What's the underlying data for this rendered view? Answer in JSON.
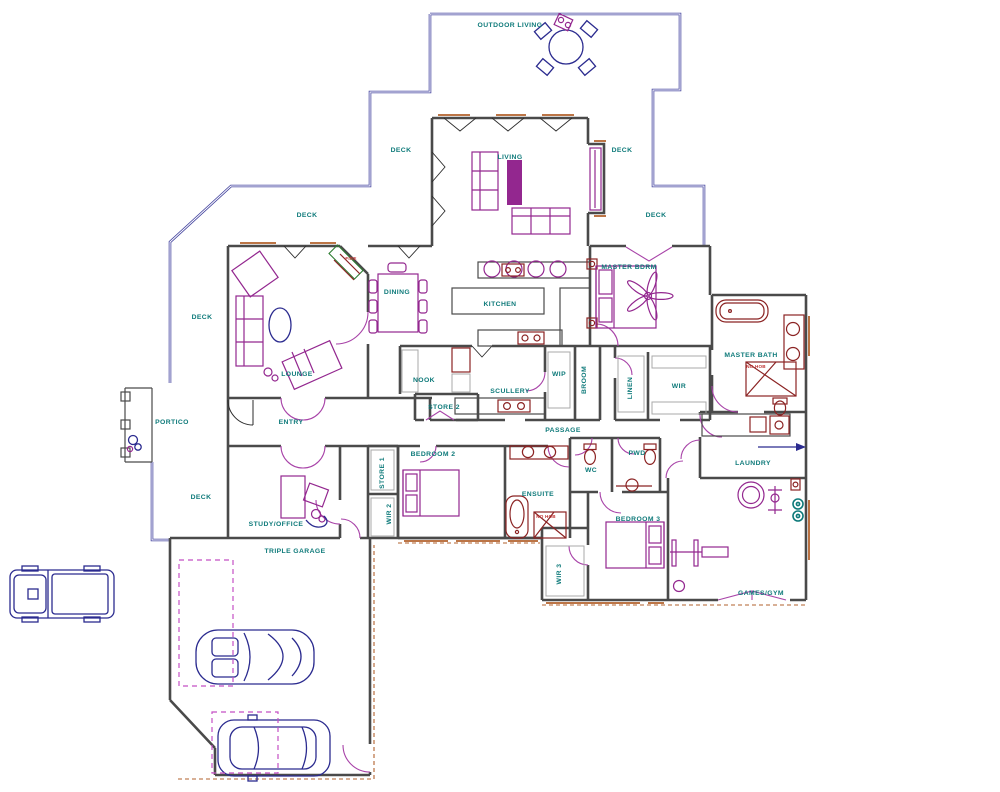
{
  "plan": {
    "rooms": {
      "outdoor_living": "OUTDOOR LIVING",
      "deck": "DECK",
      "living": "LIVING",
      "master_bdrm": "MASTER BDRM",
      "dining": "DINING",
      "kitchen": "KITCHEN",
      "master_bath": "MASTER BATH",
      "lounge": "LOUNGE",
      "nook": "NOOK",
      "wip": "WIP",
      "broom": "BROOM",
      "scullery": "SCULLERY",
      "linen": "LINEN",
      "wir": "WIR",
      "store_2": "STORE 2",
      "portico": "PORTICO",
      "entry": "ENTRY",
      "passage": "PASSAGE",
      "bedroom_2": "BEDROOM 2",
      "pwd": "PWD",
      "wc": "WC",
      "laundry": "LAUNDRY",
      "ensuite": "ENSUITE",
      "store_1": "STORE 1",
      "wir_2": "WIR 2",
      "study_office": "STUDY/OFFICE",
      "bedroom_3": "BEDROOM 3",
      "wir_3": "WIR 3",
      "triple_garage": "TRIPLE GARAGE",
      "games_gym": "GAMES/GYM"
    },
    "annotations": {
      "fire": "FIRE",
      "no_hob": "NO HOB"
    },
    "colors": {
      "wall": "#4a4a4a",
      "deck_line": "#4646a0",
      "furniture": "#93278f",
      "fixture": "#8b2323",
      "door": "#a843a8",
      "label": "#0e7a7a",
      "note": "#c03434",
      "vehicle": "#2b2b8f",
      "window_sill": "#b2622d",
      "dashed_park": "#c44fc4",
      "shelf": "#a8a8a8",
      "teal_symbol": "#0e7a7a"
    },
    "icons": [
      "round-table-icon",
      "bbq-icon",
      "sofa-icon",
      "rug-icon",
      "dining-table-icon",
      "fireplace-icon",
      "bed-icon",
      "ceiling-fan-icon",
      "bath-icon",
      "shower-icon",
      "toilet-icon",
      "basin-icon",
      "sink-icon",
      "cooktop-icon",
      "fridge-icon",
      "desk-icon",
      "office-chair-icon",
      "exercise-bike-icon",
      "gym-bench-icon",
      "gas-bottles-icon",
      "meter-box-icon",
      "flow-arrow-icon",
      "pickup-truck-icon",
      "convertible-car-icon",
      "suv-car-icon"
    ]
  }
}
